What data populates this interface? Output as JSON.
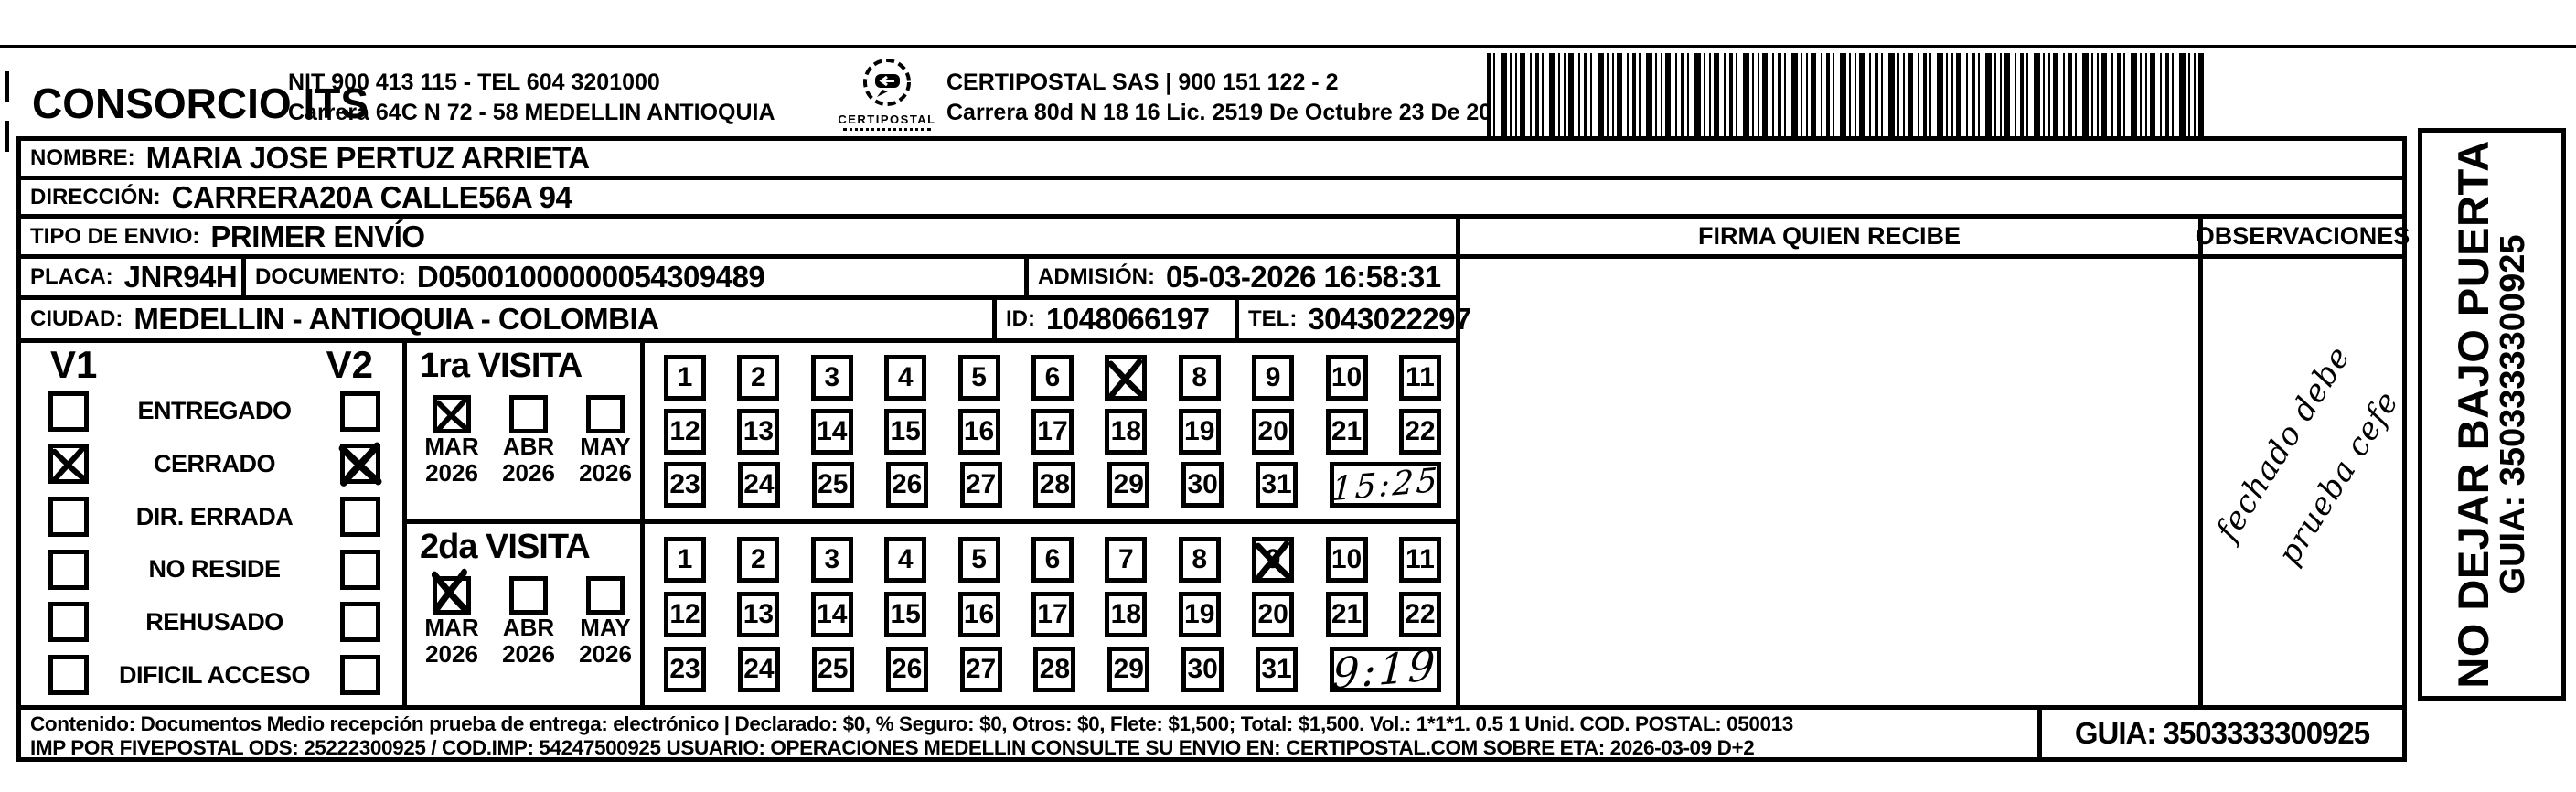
{
  "header": {
    "company": "CONSORCIO ITS",
    "nit_line": "NIT 900 413 115 - TEL 604 3201000",
    "addr_line": "Carrera 64C N 72 - 58 MEDELLIN ANTIOQUIA",
    "logo_text": "CERTIPOSTAL",
    "sas_line": "CERTIPOSTAL SAS | 900 151 122 - 2",
    "lic_line": "Carrera 80d N 18 16  Lic. 2519 De Octubre 23 De 2015"
  },
  "fields": {
    "nombre_label": "NOMBRE:",
    "nombre": "MARIA JOSE PERTUZ ARRIETA",
    "direccion_label": "DIRECCIÓN:",
    "direccion": "CARRERA20A CALLE56A 94",
    "tipo_label": "TIPO DE ENVIO:",
    "tipo": "PRIMER ENVÍO",
    "placa_label": "PLACA:",
    "placa": "JNR94H",
    "documento_label": "DOCUMENTO:",
    "documento": "D05001000000054309489",
    "admision_label": "ADMISIÓN:",
    "admision": "05-03-2026 16:58:31",
    "ciudad_label": "CIUDAD:",
    "ciudad": "MEDELLIN - ANTIOQUIA - COLOMBIA",
    "id_label": "ID:",
    "id": "1048066197",
    "tel_label": "TEL:",
    "tel": "3043022297"
  },
  "firma": {
    "header": "FIRMA QUIEN RECIBE"
  },
  "observaciones": {
    "header": "OBSERVACIONES",
    "handwriting": [
      "fechado debe",
      "prueba cefe"
    ]
  },
  "status": {
    "v1_label": "V1",
    "v2_label": "V2",
    "rows": [
      {
        "label": "ENTREGADO",
        "v1": false,
        "v2": false
      },
      {
        "label": "CERRADO",
        "v1": true,
        "v2": true
      },
      {
        "label": "DIR. ERRADA",
        "v1": false,
        "v2": false
      },
      {
        "label": "NO RESIDE",
        "v1": false,
        "v2": false
      },
      {
        "label": "REHUSADO",
        "v1": false,
        "v2": false
      },
      {
        "label": "DIFICIL ACCESO",
        "v1": false,
        "v2": false
      }
    ]
  },
  "visits": [
    {
      "title": "1ra VISITA",
      "months": [
        {
          "label": "MAR",
          "year": "2026",
          "checked": true
        },
        {
          "label": "ABR",
          "year": "2026",
          "checked": false
        },
        {
          "label": "MAY",
          "year": "2026",
          "checked": false
        }
      ],
      "day_rows": [
        [
          1,
          2,
          3,
          4,
          5,
          6,
          7,
          8,
          9,
          10,
          11
        ],
        [
          12,
          13,
          14,
          15,
          16,
          17,
          18,
          19,
          20,
          21,
          22
        ],
        [
          23,
          24,
          25,
          26,
          27,
          28,
          29,
          30,
          31
        ]
      ],
      "crossed_day": 7,
      "crossed_replaces_number": true,
      "time": "15:25"
    },
    {
      "title": "2da VISITA",
      "months": [
        {
          "label": "MAR",
          "year": "2026",
          "checked": true
        },
        {
          "label": "ABR",
          "year": "2026",
          "checked": false
        },
        {
          "label": "MAY",
          "year": "2026",
          "checked": false
        }
      ],
      "day_rows": [
        [
          1,
          2,
          3,
          4,
          5,
          6,
          7,
          8,
          9,
          10,
          11
        ],
        [
          12,
          13,
          14,
          15,
          16,
          17,
          18,
          19,
          20,
          21,
          22
        ],
        [
          23,
          24,
          25,
          26,
          27,
          28,
          29,
          30,
          31
        ]
      ],
      "crossed_day": 9,
      "crossed_replaces_number": false,
      "time": "9:19"
    }
  ],
  "sidebar": {
    "warning": "NO DEJAR BAJO PUERTA",
    "guia": "GUIA: 3503333300925"
  },
  "footer": {
    "line1": "Contenido: Documentos Medio recepción prueba de entrega: electrónico | Declarado: $0, % Seguro: $0, Otros: $0, Flete: $1,500; Total: $1,500. Vol.: 1*1*1. 0.5  1 Unid. COD. POSTAL: 050013",
    "line2": "IMP POR FIVEPOSTAL ODS: 25222300925 / COD.IMP: 54247500925 USUARIO: OPERACIONES MEDELLIN CONSULTE SU ENVIO EN: CERTIPOSTAL.COM SOBRE ETA: 2026-03-09 D+2",
    "guia": "GUIA: 3503333300925"
  }
}
